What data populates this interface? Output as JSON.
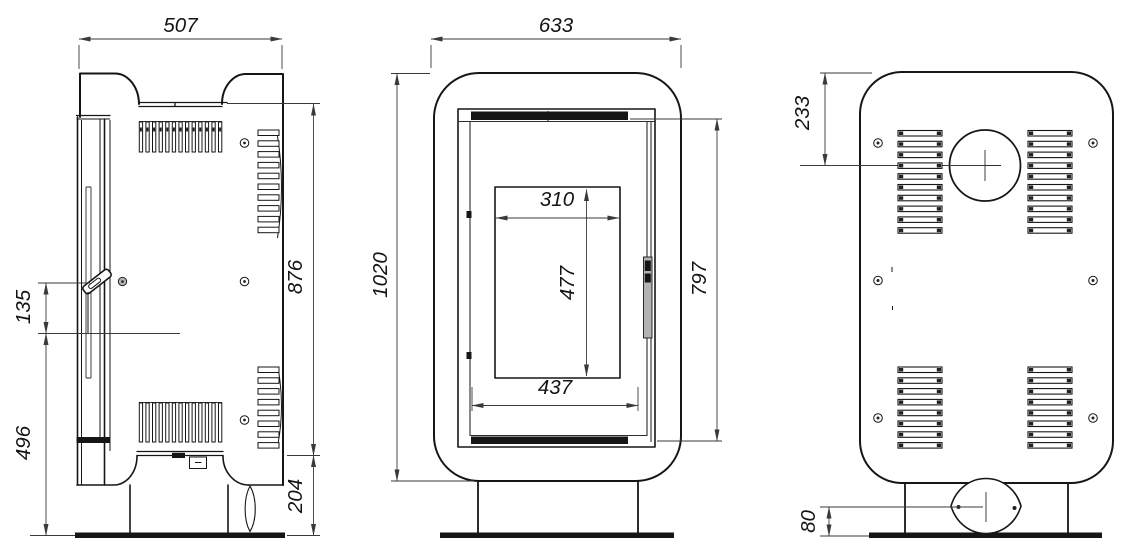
{
  "dimensions": {
    "side": {
      "overall_width": "507",
      "upper_body_height": "876",
      "handle_span": "135",
      "lower_section_height": "496",
      "plinth_height": "204"
    },
    "front": {
      "overall_width": "633",
      "overall_height": "1020",
      "glass_width": "310",
      "glass_height": "477",
      "door_opening_width": "437",
      "door_height": "797"
    },
    "back": {
      "flue_center_from_top": "233",
      "air_inlet_center_height": "80"
    }
  },
  "colors": {
    "background": "#ffffff",
    "outline": "#161616",
    "dimension_line": "#3a3a3a",
    "dimension_text": "#141414",
    "dark_fill": "#161616",
    "handle_gray": "#b3b3b3"
  }
}
